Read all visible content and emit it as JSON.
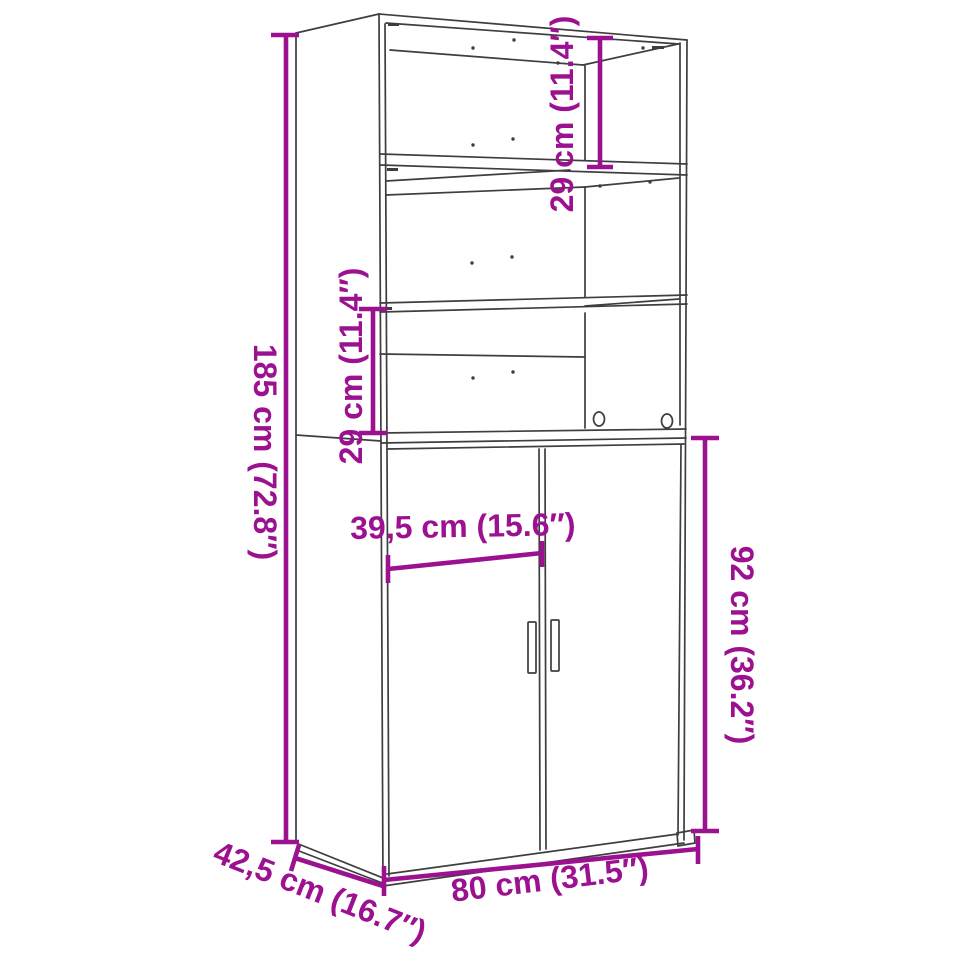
{
  "diagram": {
    "title": "highboard-dimension-diagram",
    "product": "Highboard with open shelving and two doors",
    "view": "three-quarter perspective line drawing",
    "colors": {
      "dimension_accent": "#9B1190",
      "line_art": "#3E3E3E",
      "background": "#FFFFFF"
    },
    "labels": {
      "total_height": "185 cm (72.8″)",
      "upper_shelf_gap": "29 cm (11.4″)",
      "middle_shelf_gap": "29 cm (11.4″)",
      "lower_cabinet_height": "92 cm (36.2″)",
      "door_width": "39,5 cm (15.6″)",
      "total_width": "80 cm (31.5″)",
      "total_depth": "42,5 cm (16.7″)"
    }
  }
}
